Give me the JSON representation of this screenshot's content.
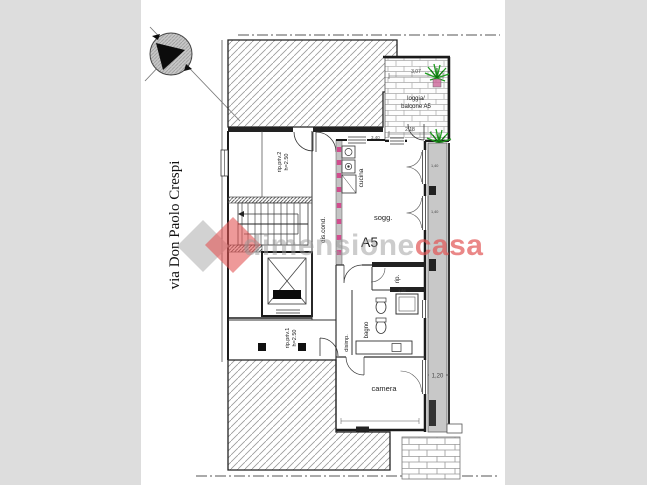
{
  "page": {
    "outer_bg": "#dddddd",
    "canvas_bg": "#ffffff"
  },
  "street": {
    "label": "via Don Paolo Crespi"
  },
  "unit_label": "A5",
  "rooms": {
    "loggia_line1": "loggia/",
    "loggia_line2": "balcone A5",
    "cucina": "cucina",
    "soggiorno": "sogg.",
    "dis_cond": "dis.cond.",
    "rip_priv2_line1": "rip.priv.2",
    "rip_priv2_line2": "h=2.50",
    "rip_priv1_line1": "rip.priv.1",
    "rip_priv1_line2": "h=2.50",
    "rip": "rip.",
    "bagno": "bagno",
    "disimp": "disimp.",
    "camera": "camera"
  },
  "dims": {
    "loggia_width": "3,07",
    "loggia_inner": "2,18",
    "kitchen_top": "3,40",
    "balcony_width": "1,20",
    "camera_width": "3,84",
    "shower": "1,84",
    "window_a": "1,40",
    "window_b": "1,40"
  },
  "watermark": {
    "text_gray": "dimensione",
    "text_red": "casa",
    "gray_color": "#9a9a9a",
    "red_color": "#e25555"
  },
  "colors": {
    "wall": "#1b1b1b",
    "hatch": "#9a9a9a",
    "balcony_gray": "#c8c8c8",
    "plant_green": "#1f9d1f",
    "pot_pink": "#cc6699",
    "tick_pink": "#d14d8e"
  }
}
